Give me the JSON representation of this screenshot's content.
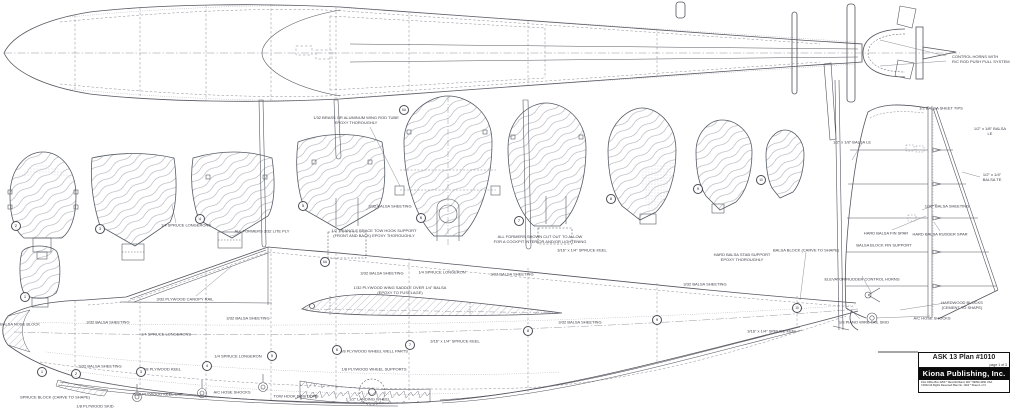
{
  "title_block": {
    "plan_title": "ASK  13 Plan #1010",
    "page_info": "page 1 of 3",
    "publisher": "Kiona Publishing, Inc.",
    "address_line": "Post Office Box 4250 * West Richland, WA * 99353-4250 USA",
    "rights_line": "©2002 All Rights Reserved      Plan No. 1010 * Sheet 1 of 3"
  },
  "colors": {
    "paper": "#ffffff",
    "outline": "#55555f",
    "construction": "#8a8a95",
    "label_text": "#3e3e48",
    "title_bar": "#0a0a0a"
  },
  "labels": [
    {
      "text": "CONTROL HORNS WITH\nR/C ROD PUSH PULL SYSTEM",
      "x": 952,
      "y": 59,
      "align": "left"
    },
    {
      "text": "1/32 BRASS OR ALUMINUM WING ROD TUBE\nEPOXY THOROUGHLY",
      "x": 356,
      "y": 120
    },
    {
      "text": "1/4 SPRUCE LONGERONS",
      "x": 186,
      "y": 225
    },
    {
      "text": "ALL FORMERS 3/32 LITE PLY",
      "x": 262,
      "y": 231
    },
    {
      "text": "3/32 BALSA SHEETING",
      "x": 390,
      "y": 206
    },
    {
      "text": "1/2 TRIANGLE BRACE TOW HOOK SUPPORT\n(FRONT AND BACK) EPOXY THOROUGHLY",
      "x": 374,
      "y": 233
    },
    {
      "text": "ALL FORMERS SHOWN CUT OUT TO ALLOW\nFOR A COCKPIT INTERIOR AND/OR LIGHTENING",
      "x": 540,
      "y": 239
    },
    {
      "text": "1/2 BALSA SHEET TIPS",
      "x": 941,
      "y": 108
    },
    {
      "text": "1/2\" x 1/8\" BALSA LE",
      "x": 852,
      "y": 142
    },
    {
      "text": "1/2\" x 1/8\" BALSA LE",
      "x": 990,
      "y": 131
    },
    {
      "text": "1/2\" x 1/4\" BALSA TE",
      "x": 992,
      "y": 177
    },
    {
      "text": "1/16\" BALSA SHEETING",
      "x": 947,
      "y": 206
    },
    {
      "text": "HARD BALSA FIN SPAR",
      "x": 886,
      "y": 233
    },
    {
      "text": "HARD BALSA RUDDER SPAR",
      "x": 940,
      "y": 234
    },
    {
      "text": "BALSA BLOCK FIN SUPPORT",
      "x": 884,
      "y": 245
    },
    {
      "text": "BALSA BLOCK (CARVE TO SHAPE)",
      "x": 806,
      "y": 250
    },
    {
      "text": "ELEVATOR/RUDDER CONTROL HORNS",
      "x": 862,
      "y": 279
    },
    {
      "text": "1/8 PIANO WIRE TAIL SKID",
      "x": 864,
      "y": 322
    },
    {
      "text": "A/C HOSE SHOCKS",
      "x": 932,
      "y": 318
    },
    {
      "text": "HARDWOOD BLOCKS\n(CEMENT TO SHAPE)",
      "x": 962,
      "y": 305
    },
    {
      "text": "3/32 PLYWOOD CANOPY RAIL",
      "x": 185,
      "y": 299
    },
    {
      "text": "BALSA NOSE BLOCK",
      "x": 20,
      "y": 324
    },
    {
      "text": "3/32 BALSA SHEETING",
      "x": 108,
      "y": 322
    },
    {
      "text": "1/4 SPRUCE LONGERONS",
      "x": 166,
      "y": 334
    },
    {
      "text": "3/32 BALSA SHEETING",
      "x": 248,
      "y": 318
    },
    {
      "text": "3/32 BALSA SHEETING",
      "x": 100,
      "y": 366
    },
    {
      "text": "1/4 SPRUCE LONGERON",
      "x": 238,
      "y": 356
    },
    {
      "text": "3/8 PLYWOOD KEEL",
      "x": 162,
      "y": 369
    },
    {
      "text": "3/32 PLYWOOD KEEL CAP",
      "x": 158,
      "y": 394
    },
    {
      "text": "A/C HOSE SHOCKS",
      "x": 232,
      "y": 392
    },
    {
      "text": "TOW HOOK POSITIONS",
      "x": 296,
      "y": 396
    },
    {
      "text": "1 1/2\" LANDING WHEEL",
      "x": 368,
      "y": 399
    },
    {
      "text": "3/8 PLYWOOD WHEEL WELL PARTS",
      "x": 374,
      "y": 351
    },
    {
      "text": "1/8 PLYWOOD WHEEL SUPPORTS",
      "x": 374,
      "y": 369
    },
    {
      "text": "SPRUCE BLOCK (CARVE TO SHAPE)",
      "x": 55,
      "y": 397
    },
    {
      "text": "1/8 PLYWOOD SKID",
      "x": 95,
      "y": 406
    },
    {
      "text": "3/32 BALSA SHEETING",
      "x": 382,
      "y": 273
    },
    {
      "text": "1/4 SPRUCE LONGERON",
      "x": 442,
      "y": 272
    },
    {
      "text": "3/32 BALSA SHEETING",
      "x": 512,
      "y": 274
    },
    {
      "text": "3/16\" x 1/4\" SPRUCE KEEL",
      "x": 582,
      "y": 250
    },
    {
      "text": "3/16\" x 1/4\" SPRUCE KEEL",
      "x": 455,
      "y": 341
    },
    {
      "text": "3/32 BALSA SHEETING",
      "x": 580,
      "y": 322
    },
    {
      "text": "3/32 BALSA SHEETING",
      "x": 705,
      "y": 284
    },
    {
      "text": "3/16\" x 1/4\" SPRUCE KEEL",
      "x": 772,
      "y": 331
    },
    {
      "text": "1/32 PLYWOOD WING SADDLE OVER 1/4\" BALSA\n(EPOXY TO FUSELAGE)",
      "x": 400,
      "y": 290
    },
    {
      "text": "HARD BALSA STAB SUPPORT\nEPOXY THOROUGHLY",
      "x": 742,
      "y": 257
    }
  ],
  "former_markers": [
    {
      "label": "1",
      "x": 25,
      "y": 297
    },
    {
      "label": "2",
      "x": 16,
      "y": 226
    },
    {
      "label": "3",
      "x": 100,
      "y": 229
    },
    {
      "label": "4",
      "x": 200,
      "y": 219
    },
    {
      "label": "5",
      "x": 303,
      "y": 206
    },
    {
      "label": "6",
      "x": 421,
      "y": 218
    },
    {
      "label": "7",
      "x": 519,
      "y": 221
    },
    {
      "label": "8",
      "x": 611,
      "y": 199
    },
    {
      "label": "9",
      "x": 698,
      "y": 189
    },
    {
      "label": "10",
      "x": 761,
      "y": 180
    },
    {
      "label": "6A",
      "x": 404,
      "y": 110
    }
  ],
  "station_markers": [
    {
      "label": "1",
      "x": 42,
      "y": 372
    },
    {
      "label": "2",
      "x": 76,
      "y": 374
    },
    {
      "label": "3",
      "x": 141,
      "y": 372
    },
    {
      "label": "4",
      "x": 207,
      "y": 366
    },
    {
      "label": "5",
      "x": 272,
      "y": 356
    },
    {
      "label": "6",
      "x": 337,
      "y": 350
    },
    {
      "label": "7",
      "x": 410,
      "y": 345
    },
    {
      "label": "8",
      "x": 528,
      "y": 331
    },
    {
      "label": "9",
      "x": 657,
      "y": 320
    },
    {
      "label": "10",
      "x": 797,
      "y": 308
    },
    {
      "label": "6A",
      "x": 325,
      "y": 262
    }
  ]
}
